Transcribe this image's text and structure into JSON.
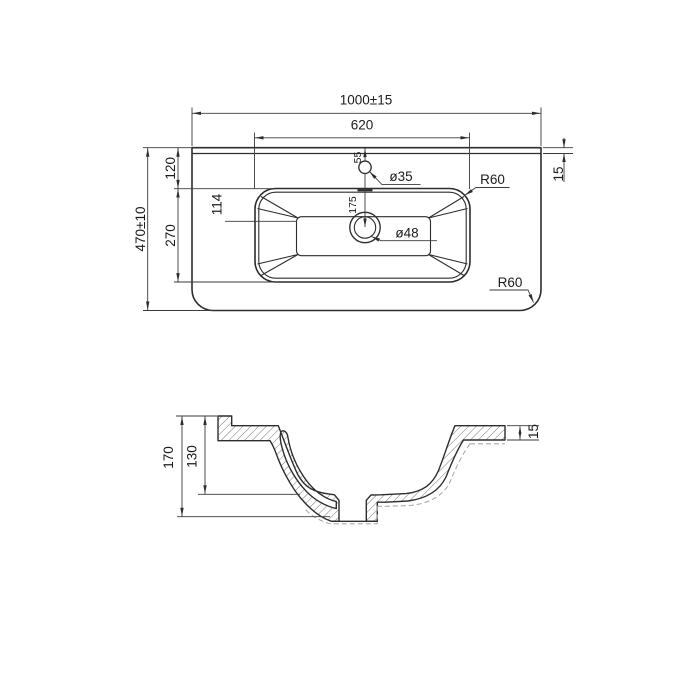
{
  "title": "Washbasin dimensioned technical drawing",
  "colors": {
    "background": "#ffffff",
    "line": "#2d2d2d",
    "dimension_line": "#3a3a3a",
    "hidden_line": "#ababab",
    "text": "#1c1c1c"
  },
  "top_view": {
    "name": "plan view",
    "dims": {
      "overall_width": "1000±15",
      "basin_width": "620",
      "overall_depth": "470±10",
      "rim_to_basin": "120",
      "basin_front_back": "270",
      "faucet_from_edge": "55",
      "faucet_to_drain": "175",
      "bottom_flat": "114",
      "faucet_hole": "ø35",
      "drain_hole": "ø48",
      "basin_corner_radius": "R60",
      "counter_corner_radius": "R60",
      "back_edge_thickness": "15"
    }
  },
  "section_view": {
    "name": "section view",
    "dims": {
      "overall_height": "170",
      "basin_depth": "130",
      "rim_thickness": "15"
    }
  }
}
